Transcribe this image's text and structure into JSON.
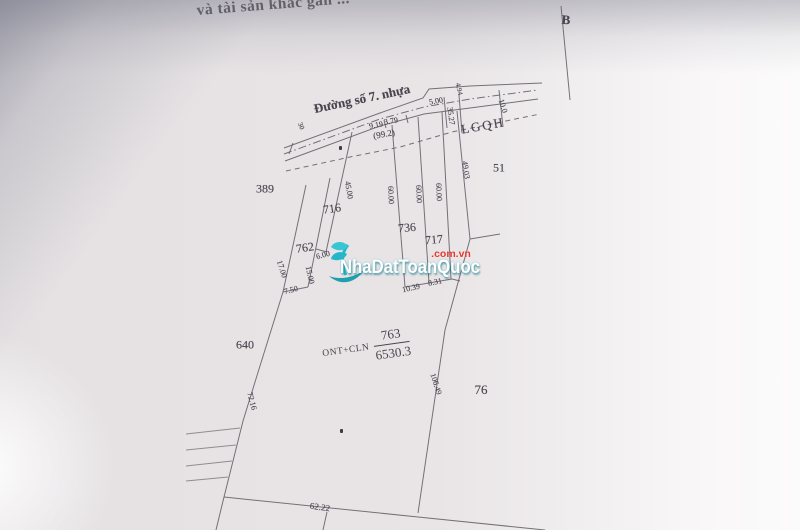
{
  "photo": {
    "header_fragment": "và tài sản khác gắn ...",
    "paper_color": "#e9e5e7",
    "line_color": "#67626c"
  },
  "watermark": {
    "brand": "NhaDatToanQuoc",
    "domain": ".com.vn",
    "teal_hex": "#14b4c6",
    "red_hex": "#e3392e"
  },
  "parcel_main": {
    "land_use_code": "ONT+CLN",
    "parcel_number": "763",
    "area": "6530.3"
  },
  "map_labels": [
    {
      "name": "road-name",
      "text": "Đường số 7. nhựa",
      "x": 362,
      "y": 99,
      "rot": -12,
      "fs": 13,
      "b": 1
    },
    {
      "name": "dim-30",
      "text": "30",
      "x": 301,
      "y": 126,
      "rot": 65,
      "fs": 7
    },
    {
      "name": "dim-9-19",
      "text": "9.19",
      "x": 376,
      "y": 125,
      "rot": -10,
      "fs": 8
    },
    {
      "name": "dim-3-79",
      "text": "3.79",
      "x": 391,
      "y": 121,
      "rot": -10,
      "fs": 8
    },
    {
      "name": "dim-99-2",
      "text": "(99.2)",
      "x": 384,
      "y": 134,
      "rot": -10,
      "fs": 9
    },
    {
      "name": "dim-4-94",
      "text": "4.94",
      "x": 459,
      "y": 89,
      "rot": 78,
      "fs": 7
    },
    {
      "name": "dim-5-00",
      "text": "5.00",
      "x": 436,
      "y": 101,
      "rot": -10,
      "fs": 8
    },
    {
      "name": "dim-35-27",
      "text": "35.27",
      "x": 451,
      "y": 116,
      "rot": 82,
      "fs": 8
    },
    {
      "name": "dim-10-0",
      "text": "10.0",
      "x": 503,
      "y": 106,
      "rot": 72,
      "fs": 8
    },
    {
      "name": "lgqh-label",
      "text": "LGQH",
      "x": 483,
      "y": 126,
      "rot": -10,
      "fs": 13,
      "ls": 2
    },
    {
      "name": "parcel-51",
      "text": "51",
      "x": 499,
      "y": 168,
      "rot": 0,
      "fs": 12
    },
    {
      "name": "parcel-389",
      "text": "389",
      "x": 265,
      "y": 189,
      "rot": 0,
      "fs": 12
    },
    {
      "name": "parcel-716",
      "text": "716",
      "x": 332,
      "y": 209,
      "rot": -8,
      "fs": 12
    },
    {
      "name": "dim-45-00",
      "text": "45.00",
      "x": 349,
      "y": 190,
      "rot": 80,
      "fs": 8
    },
    {
      "name": "dim-60-00-a",
      "text": "60.00",
      "x": 391,
      "y": 195,
      "rot": 87,
      "fs": 8
    },
    {
      "name": "dim-60-00-b",
      "text": "60.00",
      "x": 419,
      "y": 194,
      "rot": 87,
      "fs": 8
    },
    {
      "name": "dim-60-00-c",
      "text": "60.00",
      "x": 439,
      "y": 192,
      "rot": 87,
      "fs": 8
    },
    {
      "name": "dim-49-03",
      "text": "49.03",
      "x": 466,
      "y": 170,
      "rot": 82,
      "fs": 8
    },
    {
      "name": "parcel-736",
      "text": "736",
      "x": 407,
      "y": 228,
      "rot": -5,
      "fs": 12
    },
    {
      "name": "parcel-717",
      "text": "717",
      "x": 434,
      "y": 240,
      "rot": -5,
      "fs": 12
    },
    {
      "name": "parcel-762",
      "text": "762",
      "x": 305,
      "y": 248,
      "rot": -8,
      "fs": 12
    },
    {
      "name": "dim-6-00",
      "text": "6.00",
      "x": 323,
      "y": 255,
      "rot": -15,
      "fs": 8
    },
    {
      "name": "dim-17-00",
      "text": "17.00",
      "x": 282,
      "y": 269,
      "rot": 72,
      "fs": 8
    },
    {
      "name": "dim-15-00",
      "text": "15.00",
      "x": 310,
      "y": 275,
      "rot": 78,
      "fs": 8
    },
    {
      "name": "dim-7-50",
      "text": "7.50",
      "x": 291,
      "y": 290,
      "rot": -15,
      "fs": 8
    },
    {
      "name": "dim-10-39",
      "text": "10.39",
      "x": 411,
      "y": 288,
      "rot": -12,
      "fs": 8
    },
    {
      "name": "dim-8-31",
      "text": "8.31",
      "x": 435,
      "y": 282,
      "rot": -12,
      "fs": 8
    },
    {
      "name": "parcel-640",
      "text": "640",
      "x": 245,
      "y": 345,
      "rot": 0,
      "fs": 12
    },
    {
      "name": "dim-106-49",
      "text": "106.49",
      "x": 436,
      "y": 384,
      "rot": 72,
      "fs": 8
    },
    {
      "name": "parcel-76",
      "text": "76",
      "x": 481,
      "y": 390,
      "rot": 0,
      "fs": 13
    },
    {
      "name": "dim-72-16",
      "text": "72.16",
      "x": 252,
      "y": 401,
      "rot": 75,
      "fs": 8
    },
    {
      "name": "dim-62-22",
      "text": "62.22",
      "x": 320,
      "y": 507,
      "rot": 8,
      "fs": 9
    },
    {
      "name": "direction-b",
      "text": "B",
      "x": 566,
      "y": 20,
      "rot": 4,
      "fs": 13,
      "b": 1
    }
  ]
}
